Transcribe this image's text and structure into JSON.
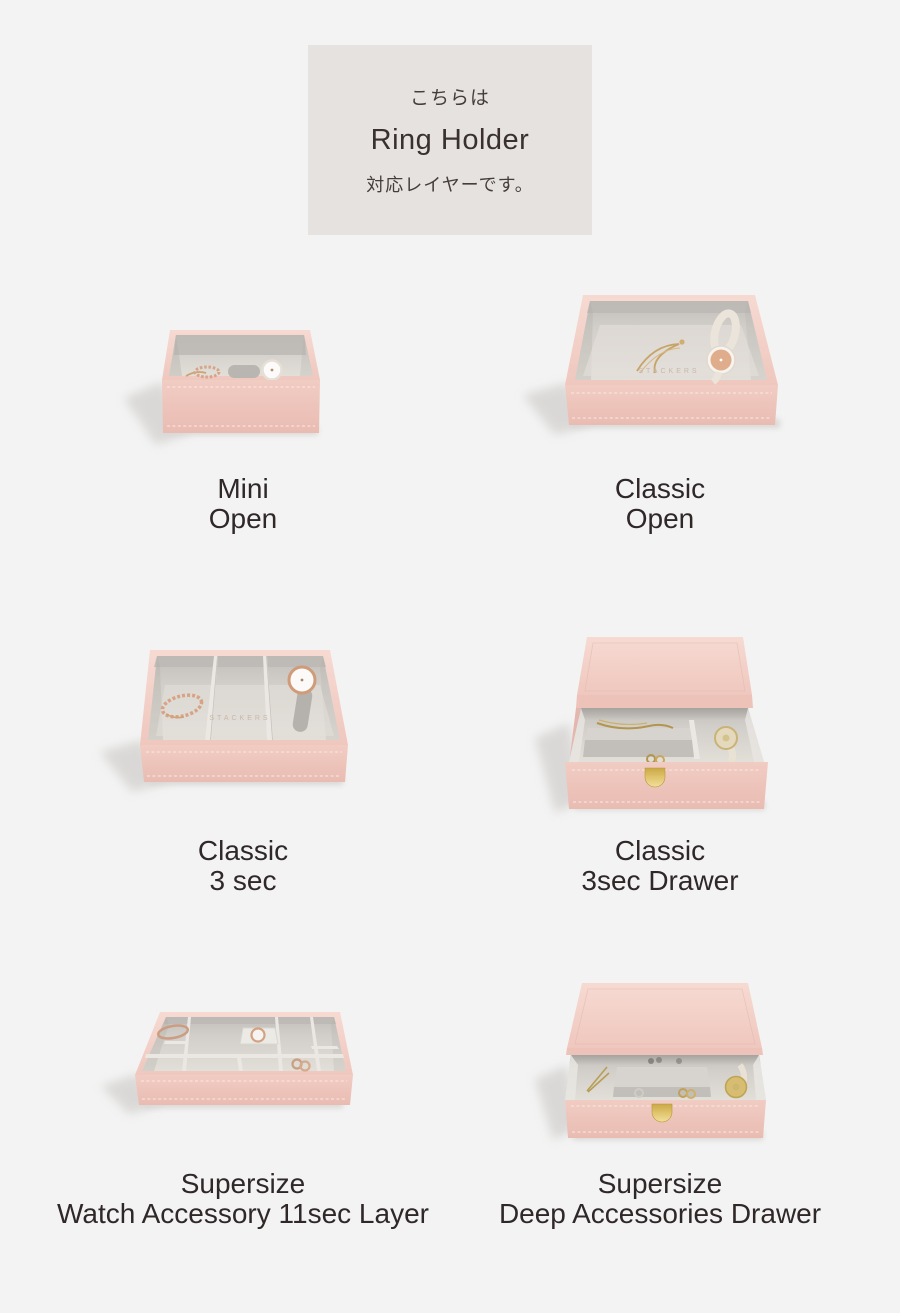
{
  "page": {
    "background_color": "#f3f3f3",
    "width_px": 900,
    "height_px": 1313
  },
  "header": {
    "line1": "こちらは",
    "line2": "Ring Holder",
    "line3": "対応レイヤーです。",
    "background_color": "#e6e2df",
    "text_color": "#39302f"
  },
  "products": [
    {
      "label_line1": "Mini",
      "label_line2": "Open"
    },
    {
      "label_line1": "Classic",
      "label_line2": "Open",
      "emboss": "STACKERS"
    },
    {
      "label_line1": "Classic",
      "label_line2": "3 sec",
      "emboss": "STACKERS"
    },
    {
      "label_line1": "Classic",
      "label_line2": "3sec Drawer"
    },
    {
      "label_line1": "Supersize",
      "label_line2": "Watch Accessory 11sec Layer"
    },
    {
      "label_line1": "Supersize",
      "label_line2": "Deep Accessories Drawer"
    }
  ],
  "colors": {
    "page_background": "#f3f3f3",
    "header_box": "#e6e2df",
    "label_text": "#2f2728",
    "blush_pink_front": "#eec6bd",
    "blush_pink_top": "#f5d6ce",
    "velvet_gray_light": "#dfdbd6",
    "velvet_gray_dark": "#c0bdb9",
    "gold_handle": "#d3ad4e",
    "rose_gold": "#d9a183"
  }
}
